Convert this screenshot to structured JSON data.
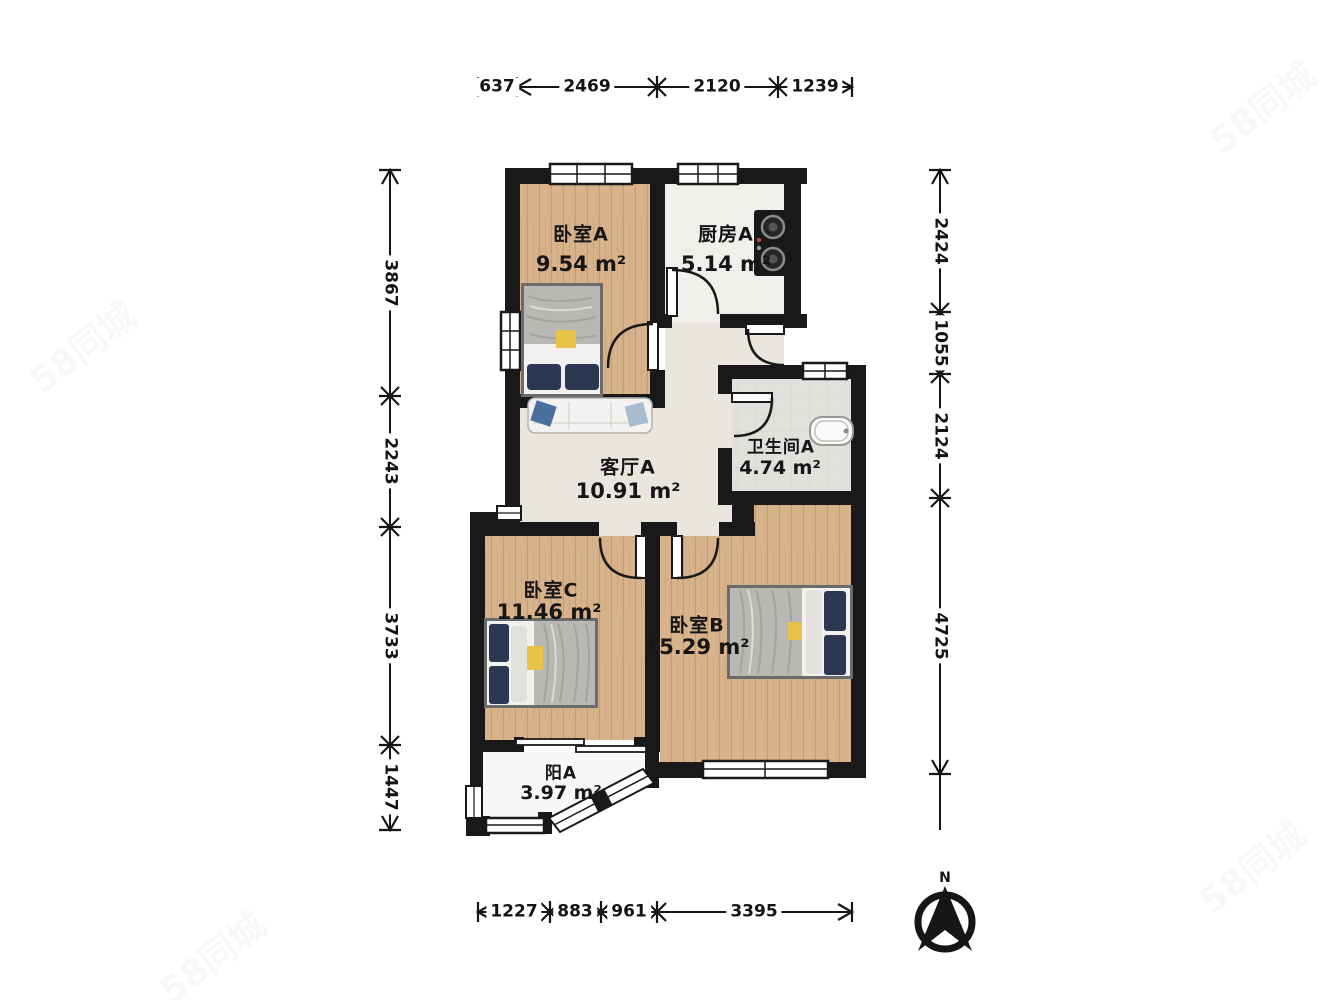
{
  "watermark": {
    "text": "58同城"
  },
  "compass": {
    "label": "N"
  },
  "rooms": [
    {
      "name": "卧室A",
      "area": "9.54 m²"
    },
    {
      "name": "厨房A",
      "area": "5.14 m²"
    },
    {
      "name": "客厅A",
      "area": "10.91 m²"
    },
    {
      "name": "卫生间A",
      "area": "4.74 m²"
    },
    {
      "name": "卧室C",
      "area": "11.46 m²"
    },
    {
      "name": "卧室B",
      "area": "15.29 m²"
    },
    {
      "name": "阳A",
      "area": "3.97 m²"
    }
  ],
  "dims": {
    "top": [
      "637",
      "2469",
      "2120",
      "1239"
    ],
    "left": [
      "3867",
      "2243",
      "3733",
      "1447"
    ],
    "right": [
      "2424",
      "1055",
      "2124",
      "4725"
    ],
    "bottom": [
      "1227",
      "883",
      "961",
      "3395"
    ]
  },
  "colors": {
    "wall": "#191919",
    "wood_floor": "#d8b28a",
    "kitchen_floor": "#f0efeb",
    "living_floor": "#eae5dd",
    "bath_floor": "#e1e0dd",
    "balcony_floor": "#f7f7f5",
    "pillow_navy": "#2c3752",
    "blanket_yellow": "#e9c24a",
    "sofa_pillow_blue": "#4a6f9e"
  }
}
